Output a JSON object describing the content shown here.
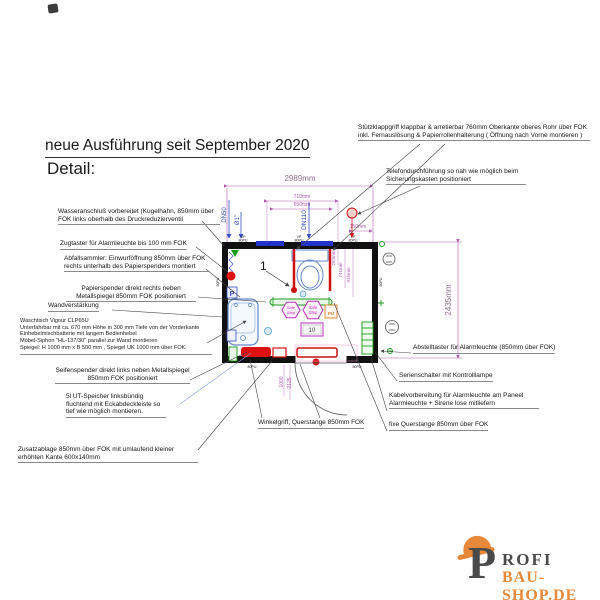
{
  "title": {
    "heading": "neue Ausführung seit September 2020",
    "subheading": "Detail:"
  },
  "annotations": {
    "left": [
      "Wasseranschluß vorbereitet (Kugelhahn, 850mm über FOK links oberhalb des Druckreduzierventil",
      "Zugtaster für Alarmleuchte bis 100 mm FOK",
      "Abfallsammler: Einwurföffnung 850mm über FOK rechts unterhalb des Papierspenders montiert",
      "Papierspender direkt rechts neben Metallspiegel 850mm FOK positioniert",
      "Wandverstärkung",
      "Seifenspender direkt links neben Metallspiegel 850mm FOK positioniert",
      "5l UT-Speicher linksbündig fluchtend mit Eckabdeckleiste so tief wie möglich montieren.",
      "Zusatzablage 850mm über FOK mit umlaufend kleiner erhöhten Kante 600x140mm"
    ],
    "washstand": [
      "Waschtisch Vigour CLP65U",
      "Unterfahrbar mit ca. 670 mm Höhe in 300 mm Tiefe von der Vorderkante",
      "Einhebelmischbatterie mit langem Bedienhebel",
      "Möbel-Siphon \"HL-137/30\" parallel zur Wand montieren",
      "Spiegel: H 1000 mm x B 500 mm ,  Spiegel UK 1000 mm über FOK."
    ],
    "right": [
      "Stützklappgriff klappbar & arretierbar  760mm Oberkante oberes Rohr über FOK inkl. Fernauslösung & Papierrollenhalterung ( Öffnung nach Vorne montieren )",
      "Telefondurchführung so nah wie möglich beim Sicherungskasten positioniert",
      "Abstelltaster für Alarmleuchte (850mm über FOK)",
      "Serienschalter mit Kontrolllampe",
      "Kabelvorbereitung für Alarmleuchte am Paneel Alarmleuchte + Sirene lose mitliefern",
      "fixe Querstange 850mm über FOK"
    ],
    "bottom": "Winkelgriff, Querstange 850mm FOK"
  },
  "dimensions": {
    "total_width": "2989mm",
    "total_height": "2435mm",
    "wc_outer": "710mm",
    "wc_inner": "550mm",
    "tele_offset": "150mm",
    "depth_1": "293mm",
    "depth_2": "741mm",
    "depth_3": "915mm",
    "door_width": "1000",
    "door_height": "2125"
  },
  "pipes": {
    "waste": "DN50",
    "water": "Ø1\"",
    "soil": "DN110"
  },
  "wall_labels": {
    "vp": "VP",
    "pu": "80PU"
  },
  "stamps": {
    "safe": "Safe",
    "step": "Step",
    "pu_box": "PU",
    "position": "10",
    "p_marker": "P",
    "item": "1"
  },
  "logo": {
    "initial": "P",
    "name": "ROFI",
    "domain": "BAU-SHOP.DE"
  },
  "colors": {
    "accent_orange": "#e8883a",
    "dimension_magenta": "#b05cb0",
    "fixture_red": "#cc1111",
    "rail_green": "#1a9a1a",
    "pipe_blue": "#3a4ec0"
  }
}
